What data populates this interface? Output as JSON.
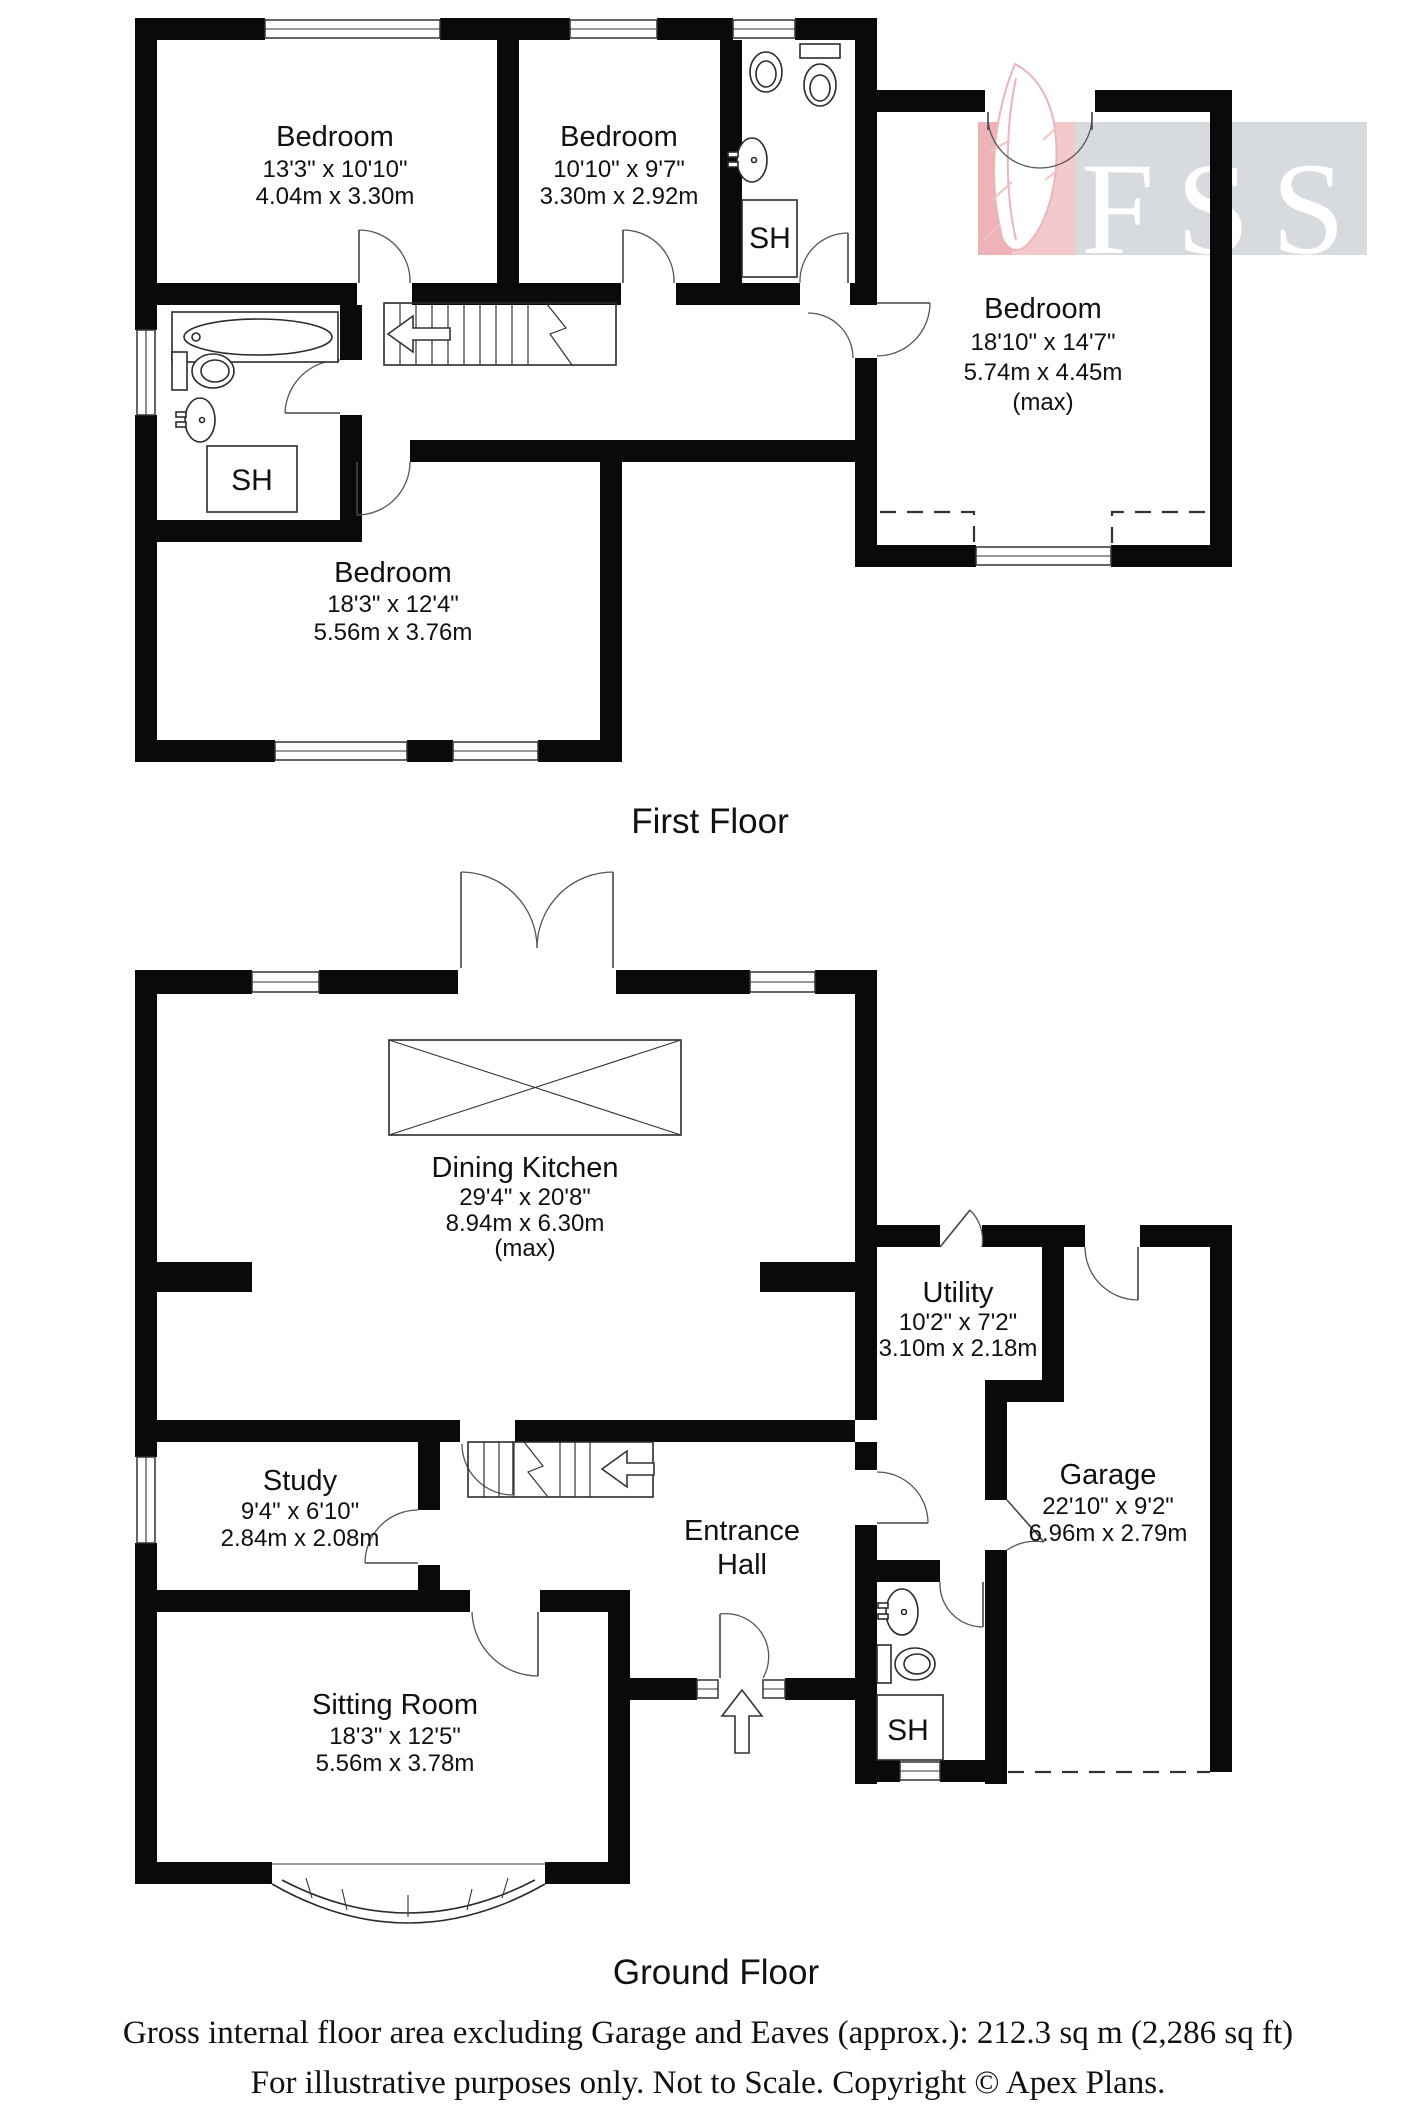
{
  "page": {
    "background": "#ffffff",
    "wall_color": "#0a0a0a"
  },
  "logo": {
    "text": "FSS",
    "panel_color": "#d7dbe0",
    "feather_panel_color": "#f4c9cb"
  },
  "titles": {
    "first": "First Floor",
    "ground": "Ground Floor"
  },
  "labels": {
    "shower": "SH"
  },
  "first_floor": {
    "bedroom1": {
      "name": "Bedroom",
      "imperial": "13'3\" x 10'10\"",
      "metric": "4.04m x 3.30m"
    },
    "bedroom2": {
      "name": "Bedroom",
      "imperial": "10'10\" x 9'7\"",
      "metric": "3.30m x 2.92m"
    },
    "bedroom3": {
      "name": "Bedroom",
      "imperial": "18'10\" x 14'7\"",
      "metric": "5.74m x 4.45m",
      "note": "(max)"
    },
    "bedroom4": {
      "name": "Bedroom",
      "imperial": "18'3\" x 12'4\"",
      "metric": "5.56m x 3.76m"
    }
  },
  "ground_floor": {
    "dining_kitchen": {
      "name": "Dining Kitchen",
      "imperial": "29'4\" x 20'8\"",
      "metric": "8.94m x 6.30m",
      "note": "(max)"
    },
    "utility": {
      "name": "Utility",
      "imperial": "10'2\" x 7'2\"",
      "metric": "3.10m x 2.18m"
    },
    "garage": {
      "name": "Garage",
      "imperial": "22'10\" x 9'2\"",
      "metric": "6.96m x 2.79m"
    },
    "study": {
      "name": "Study",
      "imperial": "9'4\" x 6'10\"",
      "metric": "2.84m x 2.08m"
    },
    "entrance_hall": {
      "line1": "Entrance",
      "line2": "Hall"
    },
    "sitting_room": {
      "name": "Sitting Room",
      "imperial": "18'3\" x 12'5\"",
      "metric": "5.56m x 3.78m"
    }
  },
  "footer": {
    "line1": "Gross internal floor area excluding Garage and Eaves (approx.): 212.3 sq m (2,286 sq ft)",
    "line2": "For illustrative purposes only. Not to Scale. Copyright © Apex Plans."
  }
}
